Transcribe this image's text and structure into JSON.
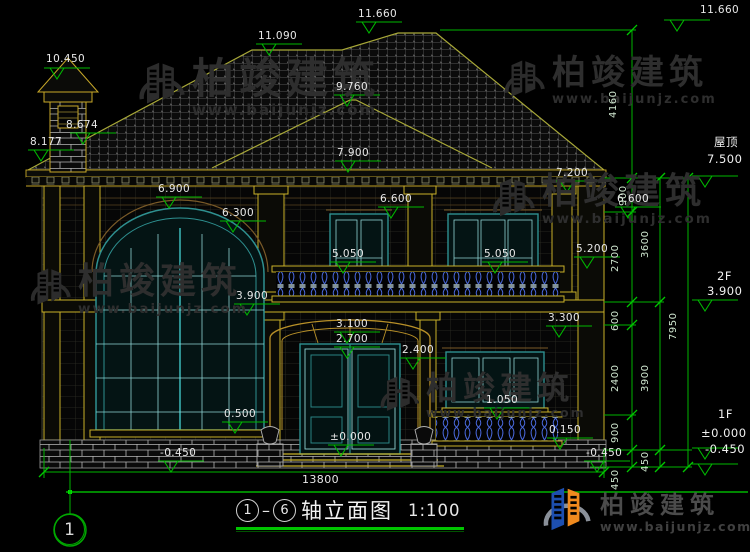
{
  "drawing": {
    "title": "轴立面图",
    "scale": "1:100",
    "axis_from": "1",
    "axis_to": "6",
    "dash": "–",
    "axis_bubble": "1"
  },
  "levels_panel": {
    "roof_label": "屋顶",
    "roof_value": "7.500",
    "f2_label": "2F",
    "f2_value": "3.900",
    "f1_label": "1F",
    "f1_value": "±0.000",
    "f1_below_value": "-0.450"
  },
  "elevations": {
    "ridge_main": "11.660",
    "overall_top": "11.660",
    "ridge_left": "11.090",
    "chimney_top": "10.450",
    "ridge_secondary": "9.760",
    "roof_slope_upper": "8.674",
    "roof_slope_lower": "8.177",
    "eave_center": "7.900",
    "eave_right": "7.200",
    "eave_left": "6.900",
    "window_head_2f_center": "6.600",
    "window_head_2f_right": "6.600",
    "arched_window_top": "6.300",
    "window_sill_2f_center": "5.050",
    "window_sill_2f_right": "5.050",
    "pilaster_base_2f": "5.200",
    "balcony_floor": "3.900",
    "railing_top_1f": "3.300",
    "entry_arch_top": "3.100",
    "entry_arch_spring": "2.700",
    "window_head_1f": "2.400",
    "window_sill_1f": "1.050",
    "base_course": "0.500",
    "entry_floor": "±0.000",
    "terrace_base": "0.150",
    "ground_left": "-0.450",
    "ground_right": "-0.450"
  },
  "dimensions": {
    "v4160": "4160",
    "v900_top": "900",
    "v2700": "2700",
    "v3600": "3600",
    "v600": "600",
    "v2400": "2400",
    "v3900": "3900",
    "v900_bottom": "900",
    "v450_inner": "450",
    "v450": "450",
    "v7950": "7950",
    "width_total": "13800"
  },
  "watermark": {
    "brand": "柏竣建筑",
    "url": "www.baijunjz.com"
  },
  "logo": {
    "brand": "柏竣建筑",
    "url": "www.baijunjz.com"
  }
}
